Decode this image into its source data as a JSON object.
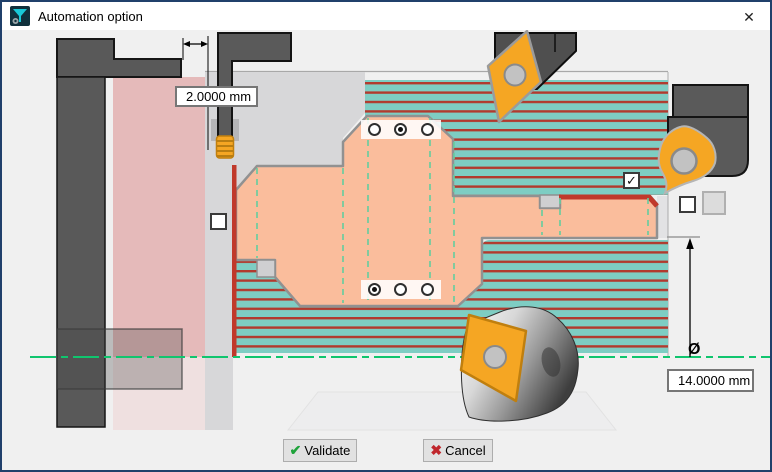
{
  "titlebar": {
    "title": "Automation option",
    "close_glyph": "✕"
  },
  "measurements": {
    "top_offset": {
      "value": "2.0000 mm"
    },
    "right_diameter": {
      "symbol": "Ø",
      "value": "14.0000 mm"
    }
  },
  "controls": {
    "check_glyph": "✓",
    "checkboxes": [
      {
        "id": "left-zone",
        "checked": false
      },
      {
        "id": "hatch-zone",
        "checked": true
      },
      {
        "id": "right-zone",
        "checked": false
      }
    ],
    "radio_groups": [
      {
        "id": "upper",
        "count": 3,
        "selected": 1
      },
      {
        "id": "lower",
        "count": 3,
        "selected": 0
      }
    ]
  },
  "footer": {
    "validate_label": "Validate",
    "validate_glyph": "✔",
    "cancel_label": "Cancel",
    "cancel_glyph": "✖"
  },
  "colors": {
    "finish_red": "#C0392B",
    "hatch_teal": "#7ECDC3",
    "hatch_red": "#B23A2E",
    "workpiece_salmon": "#FABD9C",
    "clamp_pink": "#E5BABA",
    "centerline_green": "#10C56E",
    "boundary_dash_green": "#63CE9F",
    "insert_orange": "#F5A623",
    "holder_gray": "#5A5A5A",
    "window_border_navy": "#20406B"
  }
}
